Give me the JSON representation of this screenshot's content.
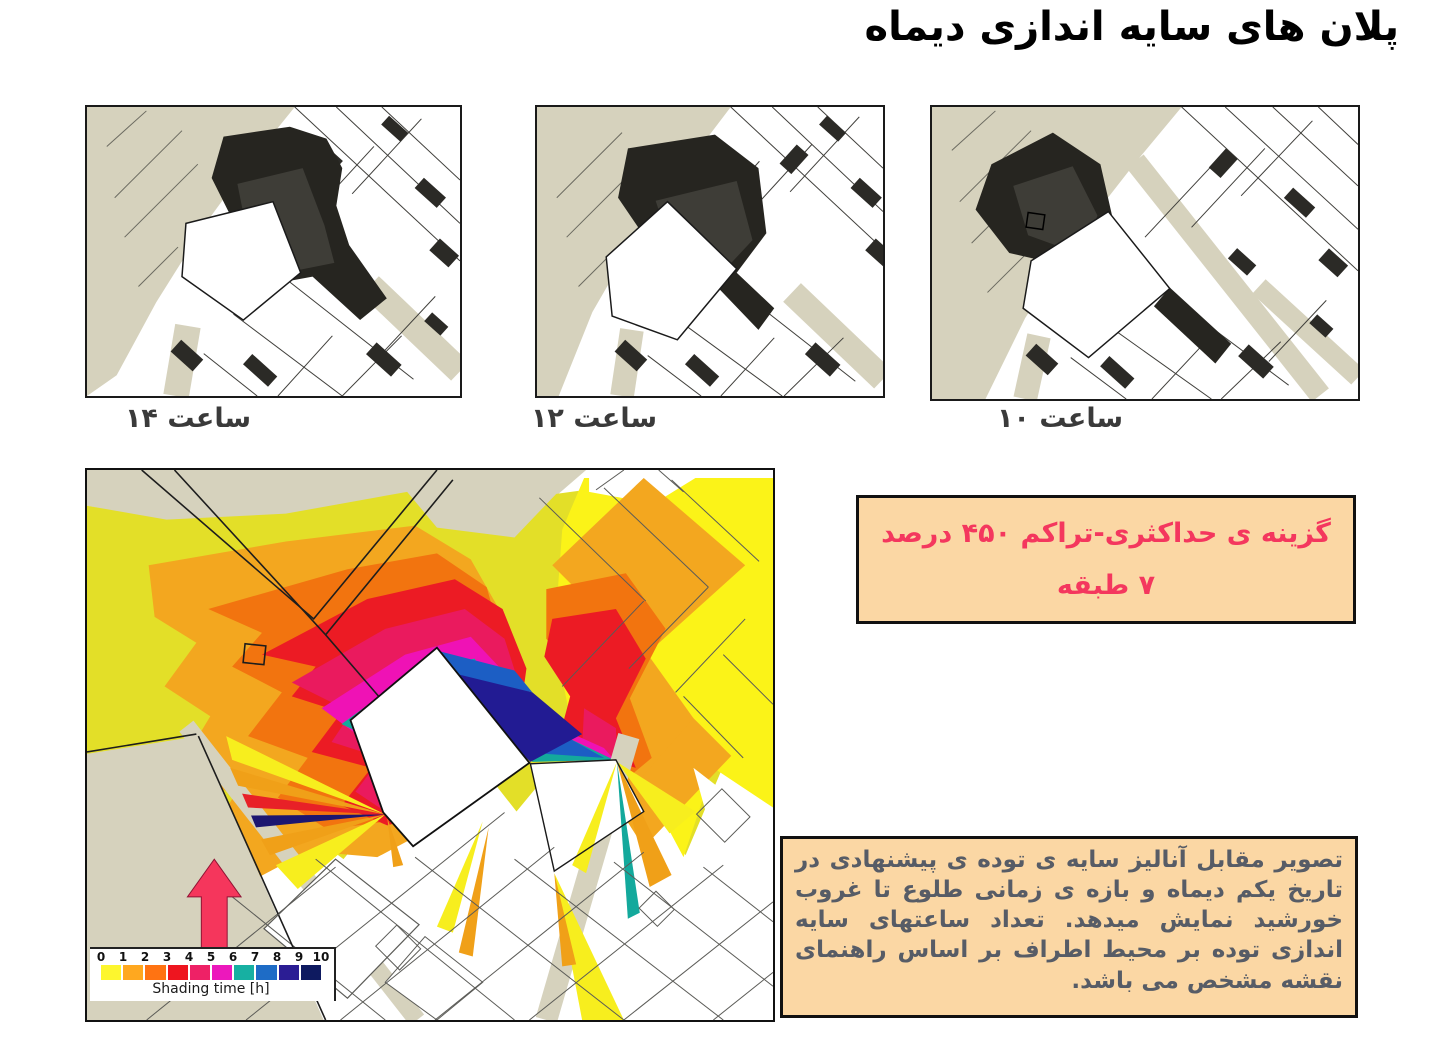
{
  "page": {
    "title": "پلان های سایه اندازی دیماه"
  },
  "hour_maps": [
    {
      "caption": "ساعت ۱۴"
    },
    {
      "caption": "ساعت ۱۲"
    },
    {
      "caption": "ساعت ۱۰"
    }
  ],
  "big_map": {
    "north_label": "شمال",
    "legend": {
      "title": "Shading time [h]",
      "tick_labels": [
        "0",
        "1",
        "2",
        "3",
        "4",
        "5",
        "6",
        "7",
        "8",
        "9",
        "10"
      ],
      "colors": [
        "#fdf62e",
        "#ffa81f",
        "#ff7312",
        "#ee151f",
        "#ee2166",
        "#ec18bc",
        "#17b0a2",
        "#1e6cc6",
        "#2b1d94",
        "#0e1a60"
      ]
    }
  },
  "option_box": {
    "line1": "گزینه ی حداکثری-تراکم ۴۵۰ درصد",
    "line2": "۷ طبقه"
  },
  "description_box": {
    "text": "تصویر مقابل آنالیز سایه ی توده ی پیشنهادی در تاریخ یکم دیماه و بازه ی زمانی طلوع تا غروب خورشید نمایش میدهد. تعداد ساعتهای سایه اندازی توده بر محیط اطراف بر اساس راهنمای نقشه مشخص می باشد."
  },
  "colors": {
    "road_beige": "#d6d2bd",
    "shadow_dark": "#262520",
    "shadow_mid": "#3e3d37",
    "box_background": "#fbd7a4",
    "accent_crimson": "#f4375e",
    "description_text": "#575c66",
    "north_arrow": "#f5365c"
  }
}
